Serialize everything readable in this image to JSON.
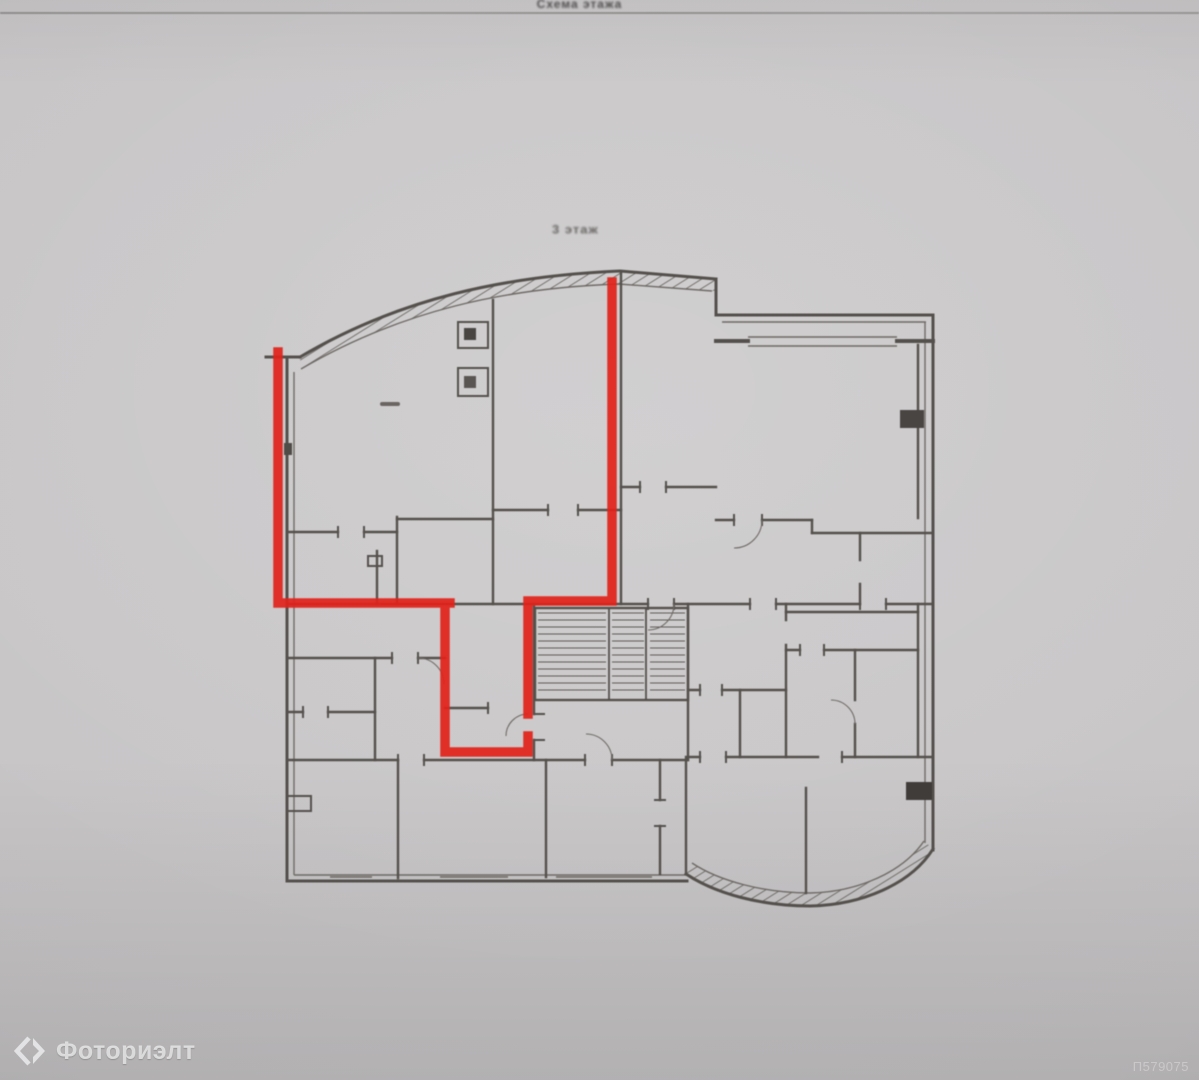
{
  "photo": {
    "top_caption": "Схема этажа",
    "floor_label": "3 этаж",
    "watermark_brand": "Фоториэлт",
    "photo_id": "П579075",
    "colors": {
      "highlight": "#e0241c",
      "ink": "#55514d",
      "ink_thin": "#6e6a66",
      "paper": "#c6c4c5"
    }
  }
}
